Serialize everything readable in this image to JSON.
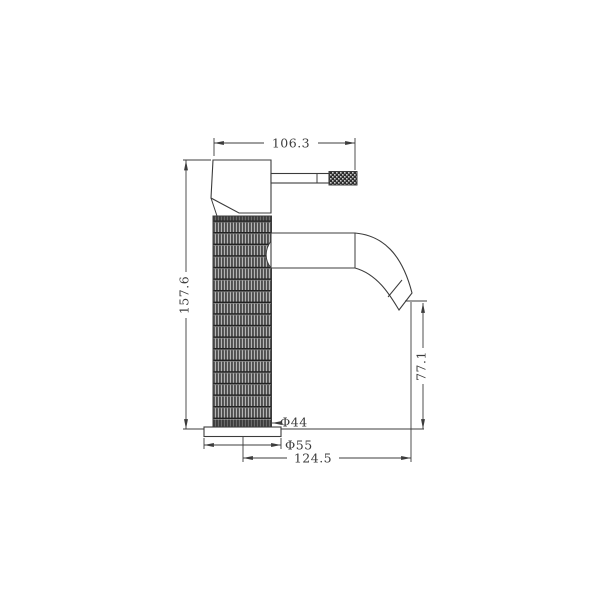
{
  "drawing": {
    "line_color": "#3c3c3c",
    "background_color": "#ffffff",
    "knurl_dark": "#4f4f4f",
    "knurl_light": "#b5b5b5",
    "dims": {
      "top_width": "106.3",
      "overall_height": "157.6",
      "spout_outlet_height": "77.1",
      "body_diameter": "Φ44",
      "base_diameter": "Φ55",
      "spout_reach": "124.5"
    }
  }
}
